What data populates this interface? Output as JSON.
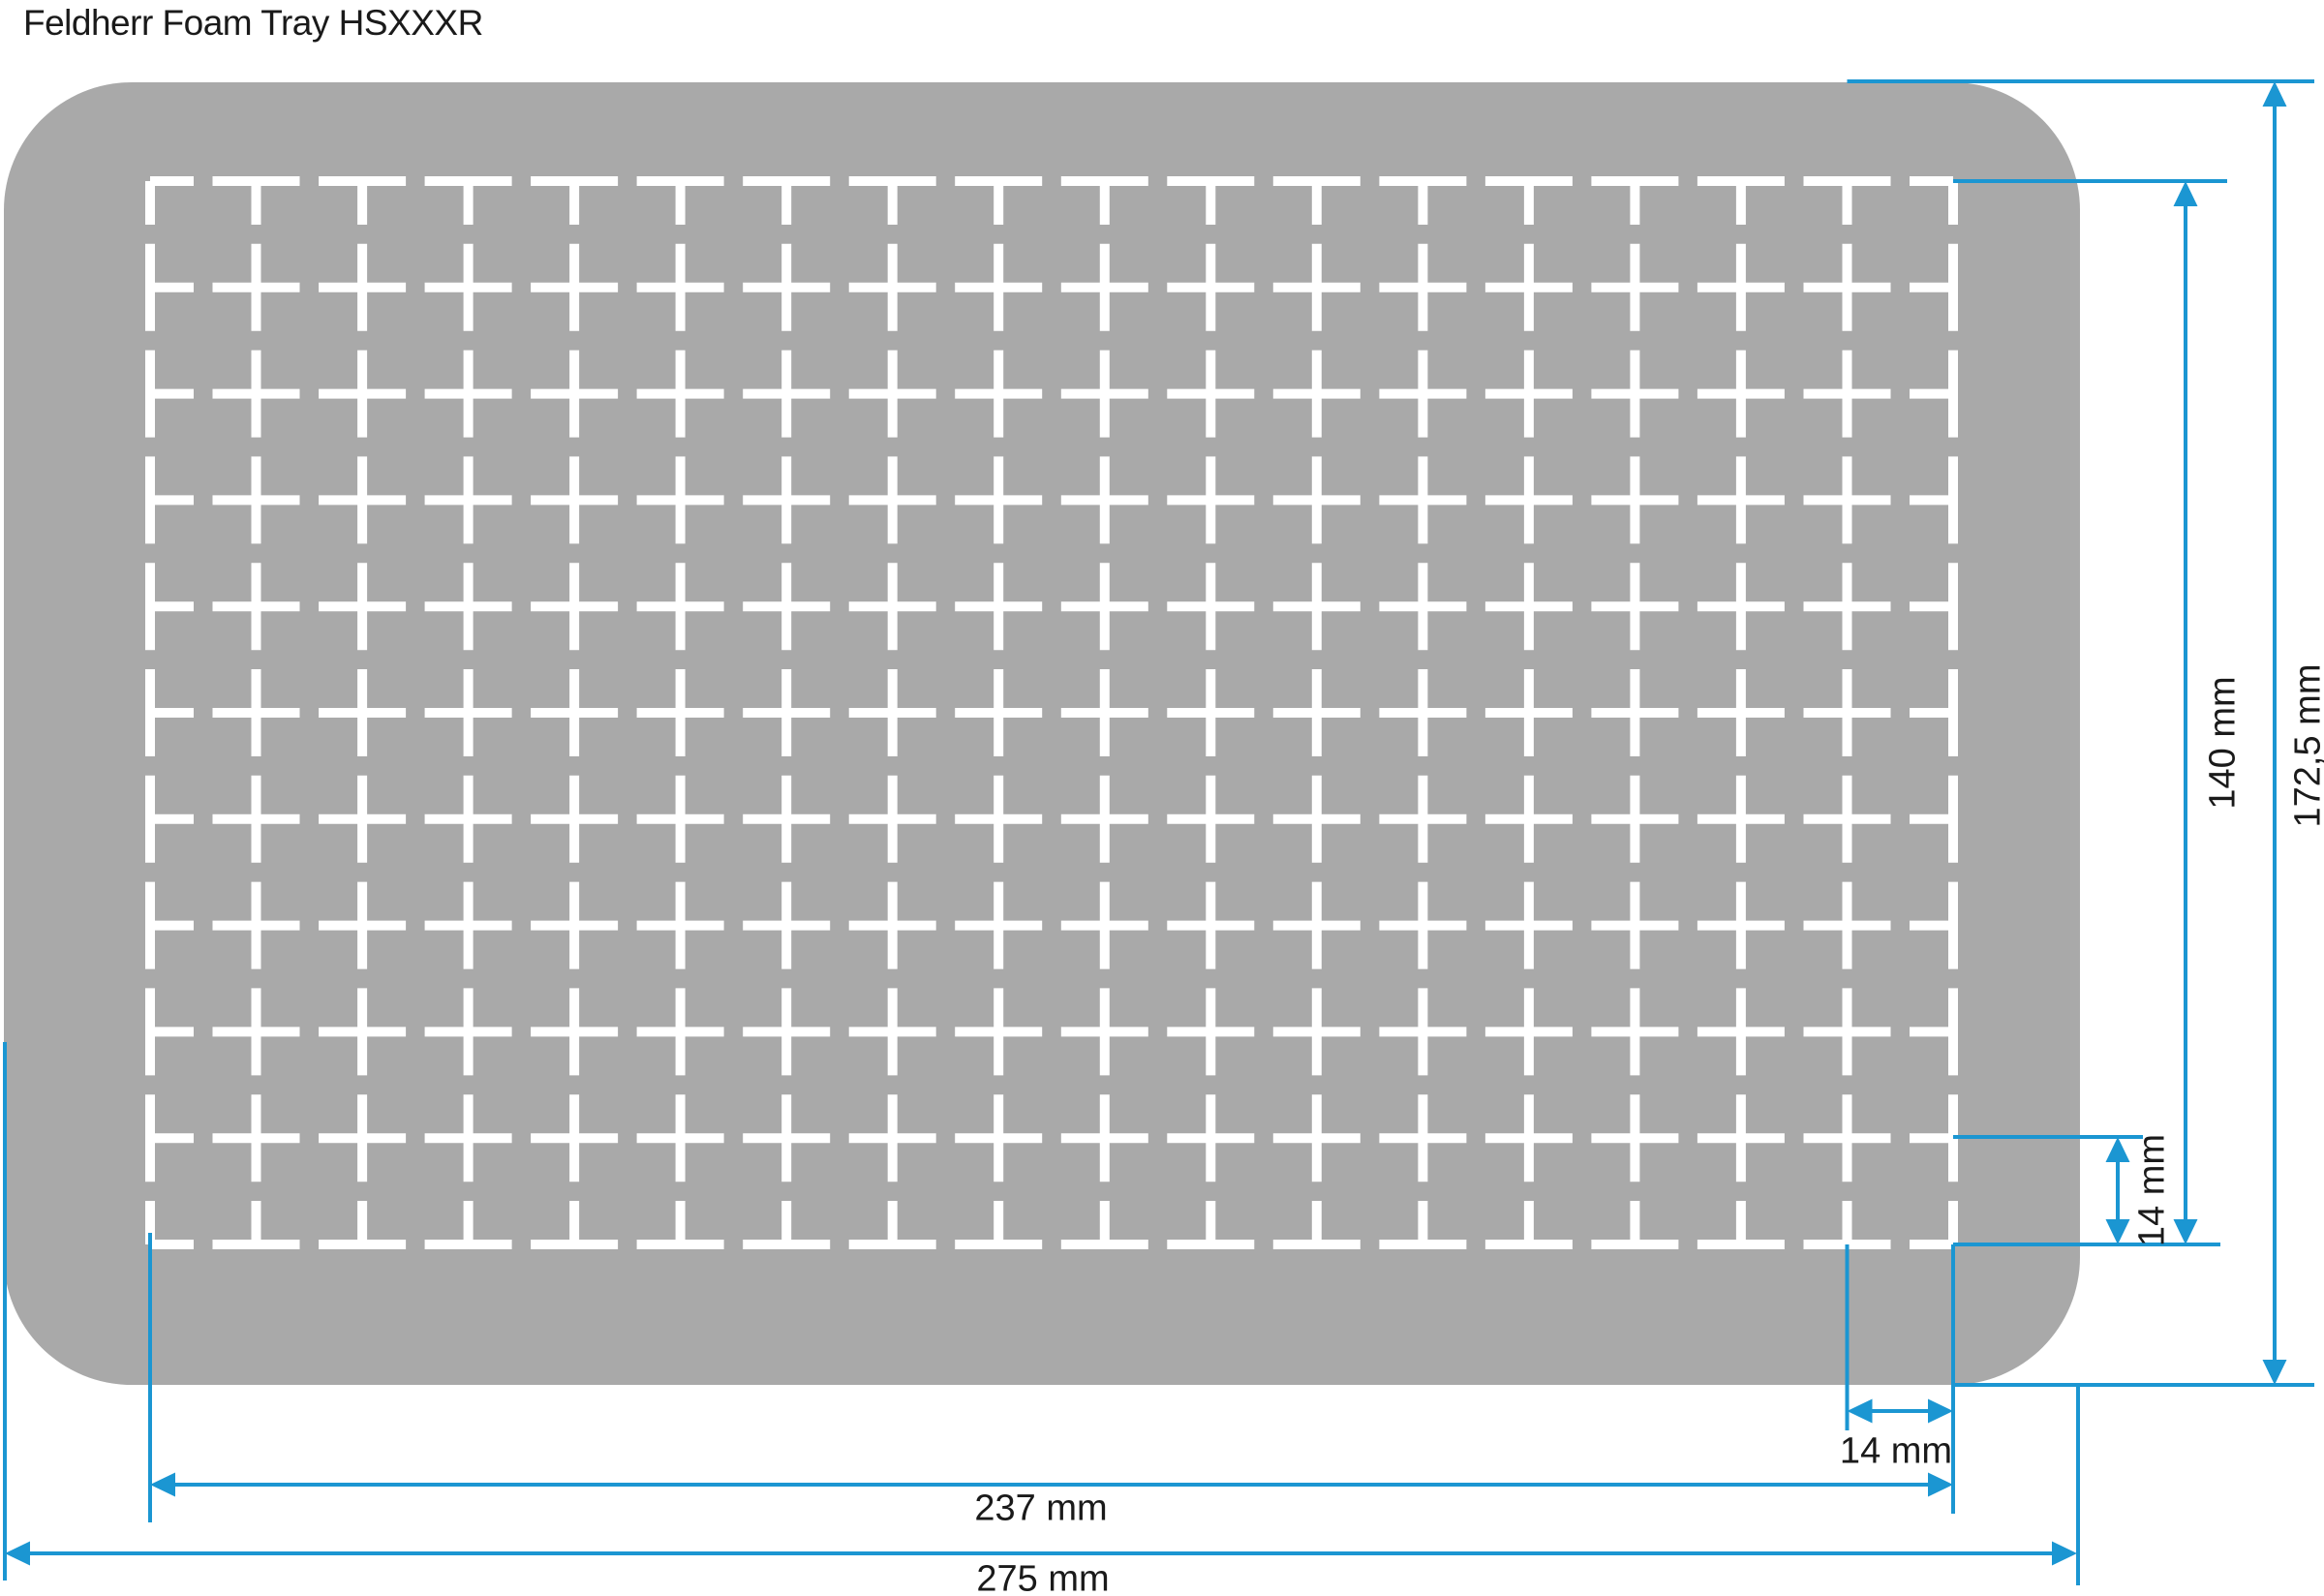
{
  "title": "Feldherr Foam Tray HSXXXR",
  "colors": {
    "tray_foam": "#A9A9A9",
    "grid_lines": "#FFFFFF",
    "dimension_lines": "#1B96D2",
    "label_text": "#1A1A1A",
    "background": "#FFFFFF"
  },
  "grid": {
    "columns": 17,
    "rows": 10
  },
  "dimensions": {
    "grid_height": {
      "label": "140 mm"
    },
    "tray_height": {
      "label": "172,5 mm"
    },
    "cell_height": {
      "label": "14 mm"
    },
    "cell_width": {
      "label": "14 mm"
    },
    "grid_width": {
      "label": "237 mm"
    },
    "tray_width": {
      "label": "275 mm"
    }
  }
}
